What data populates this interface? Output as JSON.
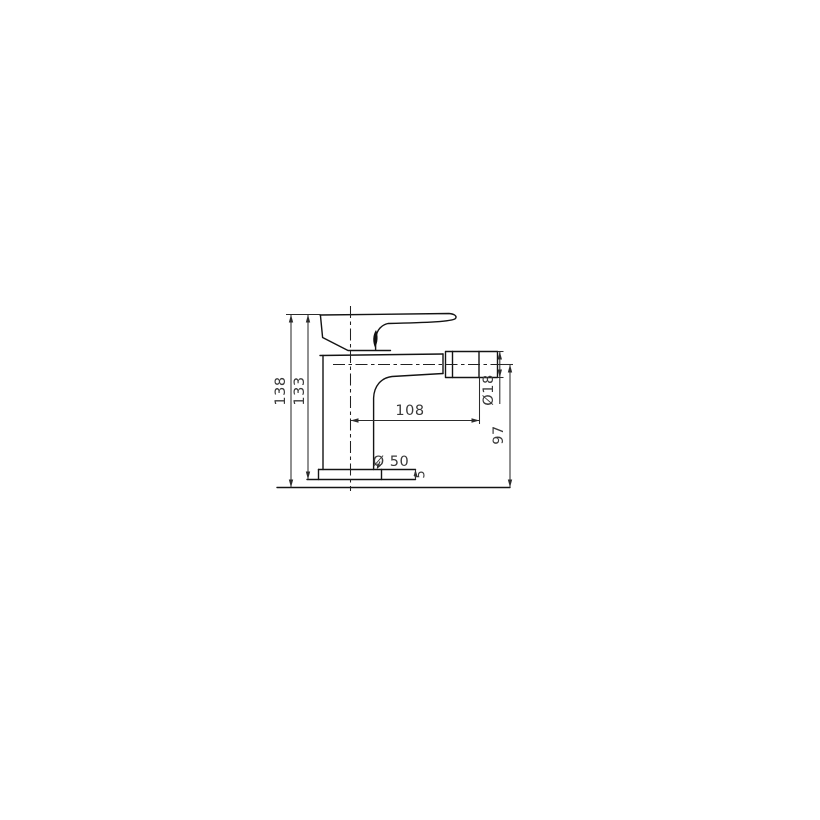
{
  "drawing": {
    "labels": {
      "total_height": "138",
      "upper_height": "133",
      "spout_reach": "108",
      "aerator_diameter": "Ø18",
      "spout_centerline_height": "97",
      "base_diameter": "Ø 50",
      "base_plate_thickness": "5"
    }
  }
}
